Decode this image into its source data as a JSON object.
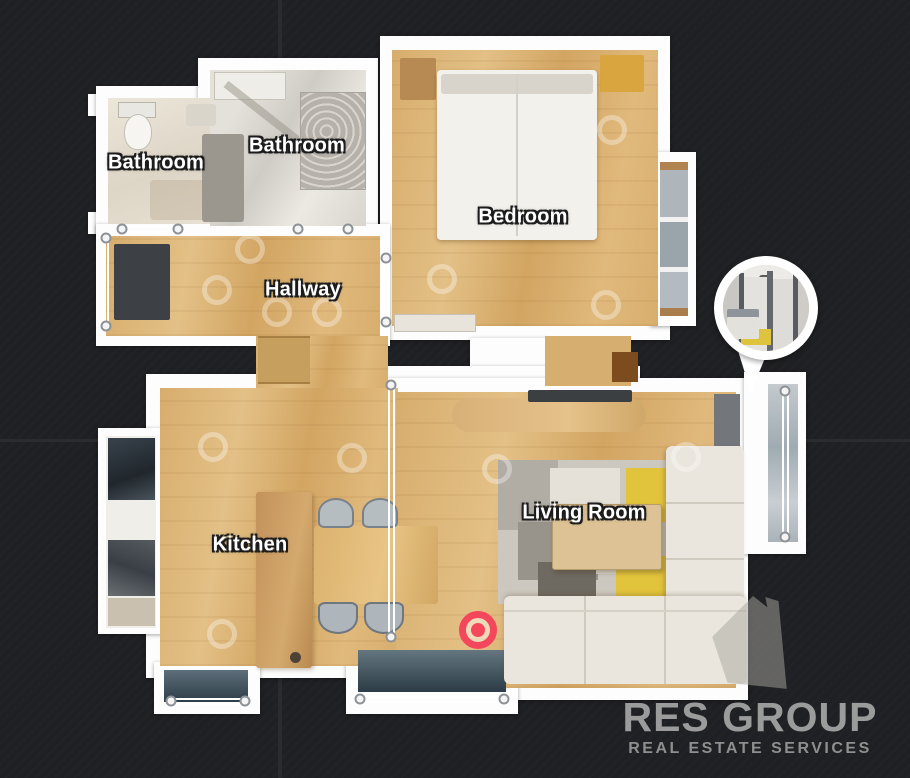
{
  "scene": {
    "type": "floorplan-view",
    "background_color": "#1f2023",
    "rooms": [
      {
        "id": "bathroom-1",
        "label": "Bathroom"
      },
      {
        "id": "bathroom-2",
        "label": "Bathroom"
      },
      {
        "id": "bedroom",
        "label": "Bedroom"
      },
      {
        "id": "hallway",
        "label": "Hallway"
      },
      {
        "id": "kitchen",
        "label": "Kitchen"
      },
      {
        "id": "living-room",
        "label": "Living Room"
      }
    ],
    "position_marker": {
      "color": "#f4475b",
      "meaning": "current-position"
    },
    "preview_bubble": {
      "meaning": "panorama-doorway-preview"
    },
    "watermark": {
      "title": "RES GROUP",
      "subtitle": "REAL ESTATE SERVICES",
      "color": "#9b9b9b"
    }
  }
}
